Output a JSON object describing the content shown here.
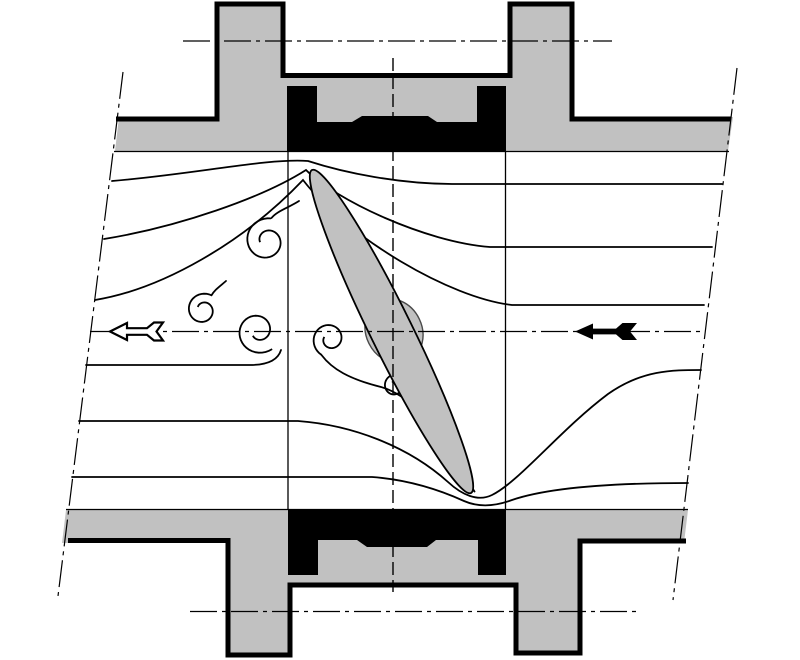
{
  "diagram": {
    "title": "butterfly-valve-flow-section",
    "canvas": {
      "width": 800,
      "height": 660,
      "background": "#ffffff"
    },
    "colors": {
      "metal": "#c1c1c1",
      "black": "#000000",
      "white": "#ffffff",
      "hubline": "#4a4a4a"
    },
    "dashdot": "27 5 4 5",
    "stemdash": "13 5",
    "shapes": [
      {
        "name": "valve-body-top-fill",
        "kind": "path",
        "d": "M119 117 L217 117 L217 2 L283 2 L283 73 L510 73 L510 2 L572 2 L572 117 L733 117 L728 151 L115 151 Z",
        "fill": "metal"
      },
      {
        "name": "valve-body-bottom-fill",
        "kind": "path",
        "d": "M66 510 L688 510 L684 543 L580 543 L580 653 L518 653 L518 585 L290 585 L290 655 L228 655 L228 543 L62 543 Z",
        "fill": "metal"
      },
      {
        "name": "seat-seal-top",
        "kind": "path",
        "d": "M287 86 L317 86 L317 122 L352 122 L362 116 L428 116 L437 122 L477 122 L477 86 L506 86 L506 151 L287 151 Z",
        "fill": "black"
      },
      {
        "name": "seat-seal-bottom",
        "kind": "path",
        "d": "M288 510 L506 510 L506 575 L478 575 L478 540 L436 540 L427 547 L367 547 L357 540 L318 540 L318 575 L288 575 Z",
        "fill": "black"
      },
      {
        "name": "valve-body-top-outline",
        "kind": "path",
        "d": "M116 119 L217 119 L217 4 L283 4 L283 75.5 L510 75.5 L510 4 L572 4 L572 119 L731 119",
        "stroke": "black",
        "width": 5
      },
      {
        "name": "valve-body-bottom-outline",
        "kind": "path",
        "d": "M68 540.5 L228 540.5 L228 655 L290 655 L290 585 L516 585 L516 653 L580 653 L580 541 L686 541",
        "stroke": "black",
        "width": 5
      },
      {
        "name": "pipe-wall-top-line",
        "kind": "path",
        "d": "M114 151.5 L729 151.5",
        "stroke": "black",
        "width": 1.3
      },
      {
        "name": "pipe-wall-bottom-line",
        "kind": "path",
        "d": "M66 509.5 L688 509.5",
        "stroke": "black",
        "width": 1.3
      },
      {
        "name": "bore-line-left",
        "kind": "path",
        "d": "M288 151 L288 510",
        "stroke": "black",
        "width": 1.3
      },
      {
        "name": "bore-line-right",
        "kind": "path",
        "d": "M505.5 151 L505.5 510",
        "stroke": "black",
        "width": 1.3
      },
      {
        "name": "break-line-left",
        "kind": "path",
        "d": "M123 72 L58 596",
        "stroke": "black",
        "width": 1.2,
        "dash": "dashdot"
      },
      {
        "name": "break-line-right",
        "kind": "path",
        "d": "M737 68 L673 600",
        "stroke": "black",
        "width": 1.2,
        "dash": "dashdot"
      },
      {
        "name": "flange-axis-top",
        "kind": "path",
        "d": "M183 41 L612 41",
        "stroke": "black",
        "width": 1.2,
        "dash": "dashdot"
      },
      {
        "name": "flange-axis-bottom",
        "kind": "path",
        "d": "M190 611.5 L638 611.5",
        "stroke": "black",
        "width": 1.2,
        "dash": "dashdot"
      },
      {
        "name": "streamline-top-1",
        "kind": "path",
        "d": "M112 181 C195 174 268 158 308 161 C345 173 400 184 452 184 L722 184",
        "stroke": "black",
        "width": 1.8,
        "cap": "round"
      },
      {
        "name": "streamline-top-2",
        "kind": "path",
        "d": "M104 239 C178 227 262 198 306 170 C336 200 425 242 490 247 L712 247",
        "stroke": "black",
        "width": 1.8,
        "cap": "round"
      },
      {
        "name": "streamline-top-3",
        "kind": "path",
        "d": "M95 300 C162 289 243 243 303 180 C348 238 450 298 512 305 L704 305",
        "stroke": "black",
        "width": 1.8,
        "cap": "round"
      },
      {
        "name": "vortex-1-tail",
        "kind": "path",
        "d": "M299 201 C288 208 277 211 271.5 218",
        "stroke": "black",
        "width": 1.8,
        "cap": "round"
      },
      {
        "name": "vortex-1",
        "kind": "spiral",
        "cx": 267,
        "cy": 241,
        "r0": 23,
        "r1": 7,
        "a0": 280,
        "sweep": -470,
        "stroke": "black",
        "width": 1.8
      },
      {
        "name": "vortex-2-tail",
        "kind": "path",
        "d": "M226 281 C219 287 214.5 290 211.5 295.3",
        "stroke": "black",
        "width": 1.8,
        "cap": "round"
      },
      {
        "name": "vortex-2",
        "kind": "spiral",
        "cx": 203,
        "cy": 310,
        "r0": 17,
        "r1": 6,
        "a0": 300,
        "sweep": -450,
        "stroke": "black",
        "width": 1.8
      },
      {
        "name": "wake-line-left",
        "kind": "path",
        "d": "M86 365 L250 365 C268 365 278 360 281 350",
        "stroke": "black",
        "width": 1.8,
        "cap": "round"
      },
      {
        "name": "vortex-3",
        "kind": "spiral",
        "cx": 258,
        "cy": 331,
        "r0": 23,
        "r1": 7,
        "a0": 52,
        "sweep": 445,
        "stroke": "black",
        "width": 1.8
      },
      {
        "name": "vortex-4",
        "kind": "spiral",
        "cx": 330,
        "cy": 339,
        "r0": 18,
        "r1": 6,
        "a0": 118,
        "sweep": 442,
        "stroke": "black",
        "width": 1.8
      },
      {
        "name": "wake-separation-line",
        "kind": "path",
        "d": "M321.5 355 C332 369 349 379 381 387 C409 395 434 424 453 456 C462 471 469 483 474.5 491.5",
        "stroke": "black",
        "width": 1.8,
        "cap": "round"
      },
      {
        "name": "vortex-5-tail",
        "kind": "path",
        "d": "M411 367.5 C406 370 401.5 371.5 399.1 374.8",
        "stroke": "black",
        "width": 1.8,
        "cap": "round"
      },
      {
        "name": "vortex-5",
        "kind": "spiral",
        "cx": 395,
        "cy": 386,
        "r0": 12,
        "r1": 4.5,
        "a0": 290,
        "sweep": -420,
        "stroke": "black",
        "width": 1.8
      },
      {
        "name": "streamline-bottom-1",
        "kind": "path",
        "d": "M79 421 L298 421 C352 425 408 446 448 482 C462 495 478 502 492 495 C520 481 560 430 608 394 C642 370 672 370 701 370",
        "stroke": "black",
        "width": 1.8,
        "cap": "round"
      },
      {
        "name": "streamline-bottom-2",
        "kind": "path",
        "d": "M72 477 L372 477 C412 480 442 491 464 501 C480 508 496 506 512 500 C550 487 620 483 688 483",
        "stroke": "black",
        "width": 1.8,
        "cap": "round"
      },
      {
        "name": "disc-hub",
        "kind": "ellipse",
        "cx": 394,
        "cy": 331,
        "rx": 28,
        "ry": 33,
        "rotate": -26.2,
        "fill": "metal",
        "stroke": "hubline",
        "width": 1.4
      },
      {
        "name": "valve-disc",
        "kind": "ellipse",
        "cx": 391.5,
        "cy": 331.5,
        "rx": 21,
        "ry": 180,
        "rotate": -26.2,
        "fill": "metal",
        "stroke": "black",
        "width": 1.8
      },
      {
        "name": "stem-axis-line",
        "kind": "path",
        "d": "M393 58 L393 592",
        "stroke": "black",
        "width": 1.4,
        "dash": "stemdash"
      },
      {
        "name": "pipe-centerline",
        "kind": "path",
        "d": "M90 331.5 L703 331.5",
        "stroke": "black",
        "width": 1.3,
        "dash": "dashdot"
      },
      {
        "name": "flow-arrow-outlet",
        "kind": "polygon",
        "points": [
          [
            110,
            331.5
          ],
          [
            127,
            323
          ],
          [
            127,
            328.2
          ],
          [
            147,
            328.2
          ],
          [
            154,
            322.5
          ],
          [
            163,
            322.5
          ],
          [
            156.5,
            331.5
          ],
          [
            163,
            340.5
          ],
          [
            154,
            340.5
          ],
          [
            147,
            334.8
          ],
          [
            127,
            334.8
          ],
          [
            127,
            340
          ]
        ],
        "fill": "white",
        "stroke": "black",
        "width": 2.2
      },
      {
        "name": "flow-arrow-inlet",
        "kind": "polygon",
        "points": [
          [
            575,
            331.5
          ],
          [
            593,
            323.5
          ],
          [
            593,
            328.6
          ],
          [
            616,
            328.6
          ],
          [
            622.5,
            323
          ],
          [
            637,
            323
          ],
          [
            630,
            331.5
          ],
          [
            637,
            340
          ],
          [
            622.5,
            340
          ],
          [
            616,
            334.4
          ],
          [
            593,
            334.4
          ],
          [
            593,
            339.5
          ]
        ],
        "fill": "black"
      }
    ]
  }
}
